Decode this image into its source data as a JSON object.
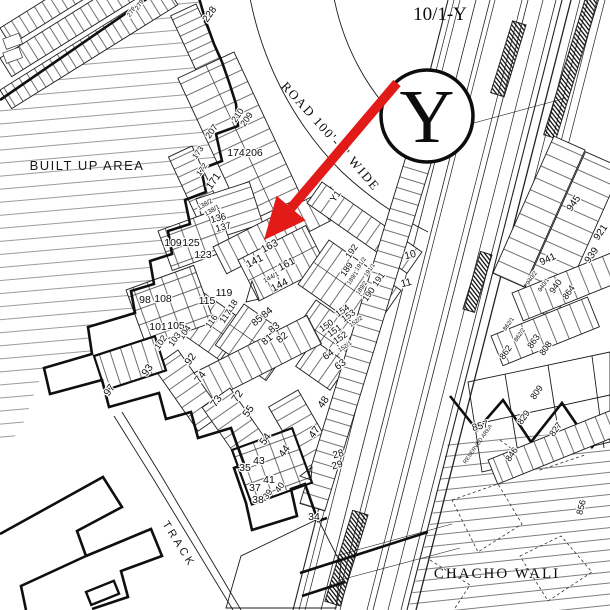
{
  "title": "10/1-Y",
  "marker": {
    "letter": "Y"
  },
  "labels": {
    "built_up_area": "BUILT UP AREA",
    "road": "ROAD 100'-0\" WIDE",
    "track": "TRACK",
    "chacho_wali": "CHACHO WALI",
    "reserved_area": "RESERVED AREA"
  },
  "colors": {
    "arrow": "#e31b18",
    "ink": "#1a1a1a",
    "background": "#ffffff"
  },
  "plot_numbers": [
    {
      "t": "228",
      "x": 212,
      "y": 16,
      "r": -55,
      "s": 10
    },
    {
      "t": "210",
      "x": 240,
      "y": 117,
      "r": -55,
      "s": 9
    },
    {
      "t": "209",
      "x": 249,
      "y": 121,
      "r": -55,
      "s": 9
    },
    {
      "t": "207",
      "x": 214,
      "y": 133,
      "r": -55,
      "s": 9
    },
    {
      "t": "174",
      "x": 236,
      "y": 156,
      "r": 0,
      "s": 10.5
    },
    {
      "t": "206",
      "x": 254,
      "y": 156,
      "r": 0,
      "s": 10.5
    },
    {
      "t": "173",
      "x": 200,
      "y": 154,
      "r": -55,
      "s": 8
    },
    {
      "t": "172",
      "x": 204,
      "y": 171,
      "r": -55,
      "s": 8
    },
    {
      "t": "171",
      "x": 216,
      "y": 183,
      "r": -55,
      "s": 10.5
    },
    {
      "t": "138/2",
      "x": 206,
      "y": 206,
      "r": -30,
      "s": 6.5
    },
    {
      "t": "138/1",
      "x": 213,
      "y": 212,
      "r": -30,
      "s": 6.5
    },
    {
      "t": "136",
      "x": 219,
      "y": 221,
      "r": -15,
      "s": 9.5
    },
    {
      "t": "137",
      "x": 224,
      "y": 230,
      "r": -15,
      "s": 9.5
    },
    {
      "t": "278",
      "x": 133,
      "y": 13,
      "r": -55,
      "s": 6.5
    },
    {
      "t": "279",
      "x": 141,
      "y": 6,
      "r": -55,
      "s": 6.5
    },
    {
      "t": "109",
      "x": 173,
      "y": 246,
      "r": 0,
      "s": 10.5
    },
    {
      "t": "125",
      "x": 191,
      "y": 246,
      "r": 0,
      "s": 10.5
    },
    {
      "t": "123",
      "x": 203,
      "y": 258,
      "r": 0,
      "s": 10.5
    },
    {
      "t": "98",
      "x": 145,
      "y": 303,
      "r": 0,
      "s": 10.5
    },
    {
      "t": "108",
      "x": 163,
      "y": 302,
      "r": 0,
      "s": 10.5
    },
    {
      "t": "101",
      "x": 158,
      "y": 330,
      "r": 0,
      "s": 10.5
    },
    {
      "t": "105",
      "x": 176,
      "y": 329,
      "r": 0,
      "s": 10.5
    },
    {
      "t": "104",
      "x": 187,
      "y": 334,
      "r": -55,
      "s": 9
    },
    {
      "t": "103",
      "x": 177,
      "y": 341,
      "r": -55,
      "s": 9
    },
    {
      "t": "102",
      "x": 163,
      "y": 344,
      "r": -55,
      "s": 9
    },
    {
      "t": "115",
      "x": 207,
      "y": 304,
      "r": 0,
      "s": 10.5
    },
    {
      "t": "119",
      "x": 224,
      "y": 296,
      "r": 0,
      "s": 10.5
    },
    {
      "t": "118",
      "x": 234,
      "y": 308,
      "r": -55,
      "s": 9
    },
    {
      "t": "117",
      "x": 228,
      "y": 318,
      "r": -55,
      "s": 9
    },
    {
      "t": "116",
      "x": 214,
      "y": 323,
      "r": -55,
      "s": 9
    },
    {
      "t": "93",
      "x": 150,
      "y": 372,
      "r": -55,
      "s": 10.5
    },
    {
      "t": "97",
      "x": 112,
      "y": 392,
      "r": -55,
      "s": 10.5
    },
    {
      "t": "92",
      "x": 193,
      "y": 361,
      "r": -55,
      "s": 10.5
    },
    {
      "t": "74",
      "x": 203,
      "y": 379,
      "r": -55,
      "s": 10.5
    },
    {
      "t": "73",
      "x": 219,
      "y": 403,
      "r": -55,
      "s": 10.5
    },
    {
      "t": "141",
      "x": 256,
      "y": 264,
      "r": -28,
      "s": 10.5
    },
    {
      "t": "163",
      "x": 271,
      "y": 249,
      "r": -28,
      "s": 10.5
    },
    {
      "t": "161",
      "x": 288,
      "y": 267,
      "r": -28,
      "s": 10.5
    },
    {
      "t": "144/1",
      "x": 272,
      "y": 279,
      "r": -28,
      "s": 6.5
    },
    {
      "t": "144",
      "x": 281,
      "y": 288,
      "r": -28,
      "s": 10.5
    },
    {
      "t": "Y1",
      "x": 338,
      "y": 198,
      "r": -55,
      "s": 9.5
    },
    {
      "t": "192",
      "x": 354,
      "y": 253,
      "r": -55,
      "s": 9
    },
    {
      "t": "191/2",
      "x": 362,
      "y": 265,
      "r": -55,
      "s": 6
    },
    {
      "t": "191/1",
      "x": 371,
      "y": 271,
      "r": -55,
      "s": 6
    },
    {
      "t": "189",
      "x": 349,
      "y": 271,
      "r": -55,
      "s": 9
    },
    {
      "t": "189/1",
      "x": 354,
      "y": 279,
      "r": -55,
      "s": 6
    },
    {
      "t": "189/2",
      "x": 363,
      "y": 289,
      "r": -55,
      "s": 6
    },
    {
      "t": "190",
      "x": 371,
      "y": 296,
      "r": -55,
      "s": 9
    },
    {
      "t": "191",
      "x": 381,
      "y": 281,
      "r": -55,
      "s": 9
    },
    {
      "t": "10",
      "x": 411,
      "y": 258,
      "r": -15,
      "s": 10.5
    },
    {
      "t": "11",
      "x": 407,
      "y": 286,
      "r": -15,
      "s": 10.5
    },
    {
      "t": "154",
      "x": 344,
      "y": 313,
      "r": -35,
      "s": 9
    },
    {
      "t": "153",
      "x": 350,
      "y": 318,
      "r": -35,
      "s": 9
    },
    {
      "t": "151",
      "x": 336,
      "y": 333,
      "r": -35,
      "s": 9
    },
    {
      "t": "150",
      "x": 328,
      "y": 328,
      "r": -35,
      "s": 9
    },
    {
      "t": "152",
      "x": 342,
      "y": 340,
      "r": -35,
      "s": 9
    },
    {
      "t": "152/1",
      "x": 346,
      "y": 348,
      "r": -35,
      "s": 6
    },
    {
      "t": "152/2",
      "x": 357,
      "y": 323,
      "r": -35,
      "s": 6
    },
    {
      "t": "84",
      "x": 269,
      "y": 315,
      "r": -40,
      "s": 10
    },
    {
      "t": "85",
      "x": 259,
      "y": 323,
      "r": -40,
      "s": 10
    },
    {
      "t": "83",
      "x": 276,
      "y": 330,
      "r": -40,
      "s": 10
    },
    {
      "t": "81",
      "x": 269,
      "y": 342,
      "r": -40,
      "s": 10
    },
    {
      "t": "82",
      "x": 284,
      "y": 340,
      "r": -40,
      "s": 10
    },
    {
      "t": "64",
      "x": 330,
      "y": 357,
      "r": -35,
      "s": 10
    },
    {
      "t": "63",
      "x": 342,
      "y": 367,
      "r": -35,
      "s": 10
    },
    {
      "t": "72",
      "x": 240,
      "y": 398,
      "r": -55,
      "s": 10.5
    },
    {
      "t": "55",
      "x": 251,
      "y": 413,
      "r": -55,
      "s": 10.5
    },
    {
      "t": "54",
      "x": 268,
      "y": 441,
      "r": -55,
      "s": 10.5
    },
    {
      "t": "44",
      "x": 287,
      "y": 453,
      "r": -55,
      "s": 10.5
    },
    {
      "t": "48",
      "x": 326,
      "y": 404,
      "r": -55,
      "s": 10.5
    },
    {
      "t": "47",
      "x": 317,
      "y": 434,
      "r": -55,
      "s": 10.5
    },
    {
      "t": "35",
      "x": 245,
      "y": 471,
      "r": 0,
      "s": 10.5
    },
    {
      "t": "43",
      "x": 259,
      "y": 464,
      "r": 0,
      "s": 10.5
    },
    {
      "t": "41",
      "x": 269,
      "y": 483,
      "r": 0,
      "s": 10.5
    },
    {
      "t": "37",
      "x": 255,
      "y": 491,
      "r": 0,
      "s": 10.5
    },
    {
      "t": "40",
      "x": 282,
      "y": 489,
      "r": -55,
      "s": 9
    },
    {
      "t": "39",
      "x": 270,
      "y": 496,
      "r": -55,
      "s": 9
    },
    {
      "t": "38",
      "x": 258,
      "y": 503,
      "r": 0,
      "s": 10.5
    },
    {
      "t": "34",
      "x": 314,
      "y": 520,
      "r": 0,
      "s": 10.5
    },
    {
      "t": "28",
      "x": 339,
      "y": 457,
      "r": -15,
      "s": 10
    },
    {
      "t": "29",
      "x": 338,
      "y": 468,
      "r": -15,
      "s": 10
    },
    {
      "t": "945",
      "x": 576,
      "y": 205,
      "r": -55,
      "s": 10
    },
    {
      "t": "921",
      "x": 603,
      "y": 234,
      "r": -55,
      "s": 10
    },
    {
      "t": "941",
      "x": 549,
      "y": 262,
      "r": -25,
      "s": 10
    },
    {
      "t": "939",
      "x": 594,
      "y": 257,
      "r": -55,
      "s": 10
    },
    {
      "t": "940/2",
      "x": 533,
      "y": 279,
      "r": -55,
      "s": 6
    },
    {
      "t": "940/1",
      "x": 545,
      "y": 286,
      "r": -55,
      "s": 6
    },
    {
      "t": "940",
      "x": 558,
      "y": 288,
      "r": -55,
      "s": 9
    },
    {
      "t": "864",
      "x": 571,
      "y": 294,
      "r": -55,
      "s": 9
    },
    {
      "t": "862/1",
      "x": 510,
      "y": 325,
      "r": -55,
      "s": 6
    },
    {
      "t": "862/2",
      "x": 521,
      "y": 336,
      "r": -55,
      "s": 6
    },
    {
      "t": "863",
      "x": 536,
      "y": 343,
      "r": -55,
      "s": 9
    },
    {
      "t": "808",
      "x": 548,
      "y": 350,
      "r": -55,
      "s": 9
    },
    {
      "t": "862",
      "x": 508,
      "y": 354,
      "r": -55,
      "s": 9
    },
    {
      "t": "857",
      "x": 481,
      "y": 429,
      "r": -15,
      "s": 10
    },
    {
      "t": "809",
      "x": 539,
      "y": 394,
      "r": -55,
      "s": 9
    },
    {
      "t": "829",
      "x": 526,
      "y": 419,
      "r": -55,
      "s": 9
    },
    {
      "t": "827",
      "x": 558,
      "y": 431,
      "r": -55,
      "s": 9
    },
    {
      "t": "846",
      "x": 514,
      "y": 456,
      "r": -55,
      "s": 9
    },
    {
      "t": "856",
      "x": 584,
      "y": 508,
      "r": -75,
      "s": 9
    }
  ]
}
